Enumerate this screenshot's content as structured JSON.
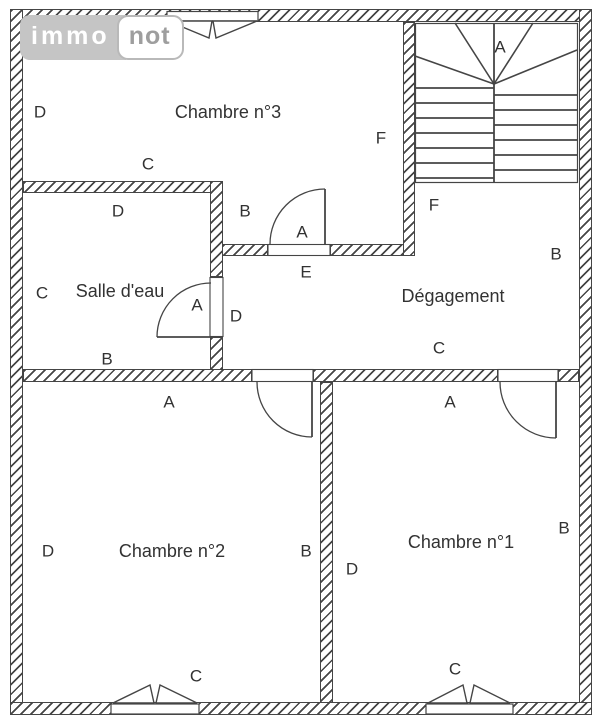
{
  "title": "Floor plan",
  "logo": {
    "immo": "immo",
    "not": "not"
  },
  "colors": {
    "line": "#454545",
    "text": "#323232",
    "logo-bg": "#c5c5c5",
    "logo-text": "#9e9e9e",
    "logo-border": "#b9b9b9"
  },
  "rooms": [
    "Chambre n°3",
    "Salle d'eau",
    "Dégagement",
    "Chambre n°2",
    "Chambre n°1"
  ],
  "labels": [
    {
      "text": "E",
      "x": 170,
      "y": 33,
      "kind": "letter"
    },
    {
      "text": "A",
      "x": 500,
      "y": 47,
      "kind": "letter"
    },
    {
      "text": "D",
      "x": 40,
      "y": 112,
      "kind": "letter"
    },
    {
      "text": "Chambre n°3",
      "x": 228,
      "y": 112,
      "kind": "room"
    },
    {
      "text": "F",
      "x": 381,
      "y": 138,
      "kind": "letter"
    },
    {
      "text": "C",
      "x": 148,
      "y": 164,
      "kind": "letter"
    },
    {
      "text": "F",
      "x": 434,
      "y": 205,
      "kind": "letter"
    },
    {
      "text": "D",
      "x": 118,
      "y": 211,
      "kind": "letter"
    },
    {
      "text": "B",
      "x": 245,
      "y": 211,
      "kind": "letter"
    },
    {
      "text": "A",
      "x": 302,
      "y": 232,
      "kind": "letter"
    },
    {
      "text": "B",
      "x": 556,
      "y": 254,
      "kind": "letter"
    },
    {
      "text": "E",
      "x": 306,
      "y": 272,
      "kind": "letter"
    },
    {
      "text": "C",
      "x": 42,
      "y": 293,
      "kind": "letter"
    },
    {
      "text": "Salle d'eau",
      "x": 120,
      "y": 291,
      "kind": "room"
    },
    {
      "text": "A",
      "x": 197,
      "y": 305,
      "kind": "letter"
    },
    {
      "text": "Dégagement",
      "x": 453,
      "y": 296,
      "kind": "room"
    },
    {
      "text": "D",
      "x": 236,
      "y": 316,
      "kind": "letter"
    },
    {
      "text": "B",
      "x": 107,
      "y": 359,
      "kind": "letter"
    },
    {
      "text": "C",
      "x": 439,
      "y": 348,
      "kind": "letter"
    },
    {
      "text": "A",
      "x": 169,
      "y": 402,
      "kind": "letter"
    },
    {
      "text": "A",
      "x": 450,
      "y": 402,
      "kind": "letter"
    },
    {
      "text": "B",
      "x": 564,
      "y": 528,
      "kind": "letter"
    },
    {
      "text": "Chambre n°1",
      "x": 461,
      "y": 542,
      "kind": "room"
    },
    {
      "text": "D",
      "x": 48,
      "y": 551,
      "kind": "letter"
    },
    {
      "text": "Chambre n°2",
      "x": 172,
      "y": 551,
      "kind": "room"
    },
    {
      "text": "B",
      "x": 306,
      "y": 551,
      "kind": "letter"
    },
    {
      "text": "D",
      "x": 352,
      "y": 569,
      "kind": "letter"
    },
    {
      "text": "C",
      "x": 455,
      "y": 669,
      "kind": "letter"
    },
    {
      "text": "C",
      "x": 196,
      "y": 676,
      "kind": "letter"
    }
  ]
}
